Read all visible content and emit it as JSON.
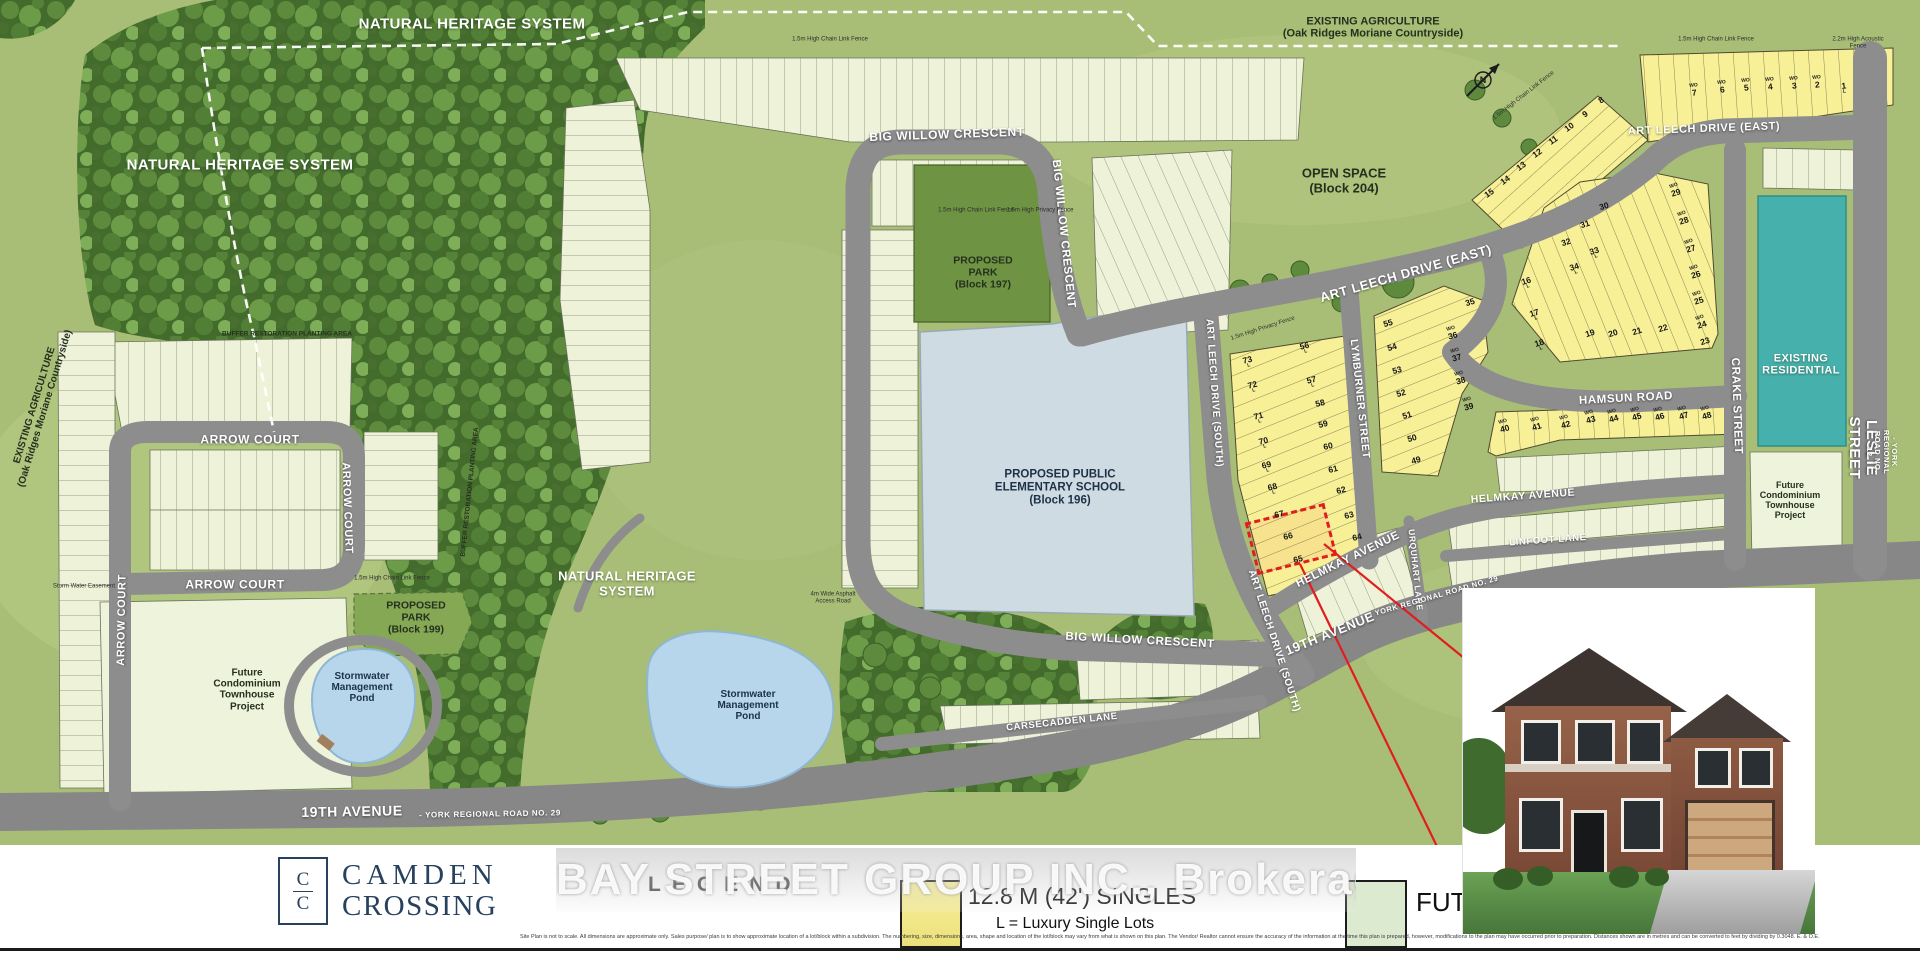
{
  "map": {
    "compass": "N",
    "labels": [
      {
        "id": "nhs-label-top",
        "t": "NATURAL HERITAGE SYSTEM",
        "x": 472,
        "y": 25,
        "fs": 15,
        "c": "lw"
      },
      {
        "id": "nhs-label-left",
        "t": "NATURAL HERITAGE SYSTEM",
        "x": 240,
        "y": 166,
        "fs": 15,
        "c": "lw"
      },
      {
        "id": "nhs-label-mid",
        "t": "NATURAL HERITAGE\nSYSTEM",
        "x": 627,
        "y": 584,
        "fs": 13,
        "c": "lw"
      },
      {
        "id": "existing-agriculture-topright",
        "t": "EXISTING AGRICULTURE\n(Oak Ridges Moriane Countryside)",
        "x": 1373,
        "y": 28,
        "fs": 11,
        "c": "ld"
      },
      {
        "id": "existing-agriculture-left",
        "t": "EXISTING AGRICULTURE\n(Oak Ridges Moriane Countryside)",
        "x": 40,
        "y": 407,
        "fs": 10,
        "rot": -73,
        "c": "ld"
      },
      {
        "id": "open-space-block-204",
        "t": "OPEN SPACE\n(Block 204)",
        "x": 1344,
        "y": 181,
        "fs": 13,
        "c": "ld"
      },
      {
        "id": "proposed-park-block-197",
        "t": "PROPOSED\nPARK\n(Block 197)",
        "x": 983,
        "y": 273,
        "fs": 10.5,
        "c": "ld"
      },
      {
        "id": "proposed-school-block-196",
        "t": "PROPOSED PUBLIC\nELEMENTARY SCHOOL\n(Block 196)",
        "x": 1060,
        "y": 488,
        "fs": 11.5,
        "c": "ln"
      },
      {
        "id": "proposed-park-block-199",
        "t": "PROPOSED\nPARK\n(Block 199)",
        "x": 416,
        "y": 618,
        "fs": 10.5,
        "c": "ld"
      },
      {
        "id": "future-condo-left",
        "t": "Future\nCondominium\nTownhouse\nProject",
        "x": 247,
        "y": 690,
        "fs": 10,
        "c": "ld"
      },
      {
        "id": "future-condo-right",
        "t": "Future\nCondominium\nTownhouse\nProject",
        "x": 1790,
        "y": 500,
        "fs": 9,
        "c": "ld"
      },
      {
        "id": "stormwater-pond-left",
        "t": "Stormwater\nManagement\nPond",
        "x": 362,
        "y": 688,
        "fs": 10,
        "c": "ln"
      },
      {
        "id": "stormwater-pond-mid",
        "t": "Stormwater\nManagement\nPond",
        "x": 748,
        "y": 706,
        "fs": 10,
        "c": "ln"
      },
      {
        "id": "existing-residential",
        "t": "EXISTING\nRESIDENTIAL",
        "x": 1801,
        "y": 365,
        "fs": 11,
        "c": "lw"
      },
      {
        "id": "buffer-restoration-h",
        "t": "BUFFER RESTORATION PLANTING AREA",
        "x": 287,
        "y": 334,
        "fs": 6.5,
        "c": "ld"
      },
      {
        "id": "buffer-restoration-v",
        "t": "BUFFER RESTORATION PLANTING AREA",
        "x": 470,
        "y": 492,
        "fs": 6.5,
        "rot": -84,
        "c": "ld"
      },
      {
        "id": "road-big-willow-top",
        "t": "BIG WILLOW CRESCENT",
        "x": 947,
        "y": 135,
        "fs": 12,
        "rot": -2,
        "c": "lr"
      },
      {
        "id": "road-big-willow-right",
        "t": "BIG WILLOW CRESCENT",
        "x": 1063,
        "y": 234,
        "fs": 11.5,
        "rot": 84,
        "c": "lr"
      },
      {
        "id": "road-big-willow-south",
        "t": "BIG WILLOW CRESCENT",
        "x": 1140,
        "y": 641,
        "fs": 11.5,
        "rot": 3,
        "c": "lr"
      },
      {
        "id": "road-arrow-court-top",
        "t": "ARROW COURT",
        "x": 250,
        "y": 440,
        "fs": 12,
        "c": "lr"
      },
      {
        "id": "road-arrow-court-right",
        "t": "ARROW COURT",
        "x": 347,
        "y": 508,
        "fs": 11,
        "rot": 88,
        "c": "lr"
      },
      {
        "id": "road-arrow-court-bottom",
        "t": "ARROW COURT",
        "x": 235,
        "y": 585,
        "fs": 12,
        "c": "lr"
      },
      {
        "id": "road-arrow-court-left",
        "t": "ARROW COURT",
        "x": 122,
        "y": 620,
        "fs": 11,
        "rot": -89,
        "c": "lr"
      },
      {
        "id": "road-art-leech-east-central",
        "t": "ART LEECH DRIVE (EAST)",
        "x": 1406,
        "y": 274,
        "fs": 13,
        "rot": -16,
        "c": "lr"
      },
      {
        "id": "road-art-leech-east-ne",
        "t": "ART LEECH DRIVE (EAST)",
        "x": 1704,
        "y": 129,
        "fs": 11,
        "rot": -2,
        "c": "lr"
      },
      {
        "id": "road-art-leech-south-upper",
        "t": "ART LEECH DRIVE (SOUTH)",
        "x": 1214,
        "y": 393,
        "fs": 10,
        "rot": 86,
        "c": "lr"
      },
      {
        "id": "road-art-leech-south-lower",
        "t": "ART LEECH DRIVE (SOUTH)",
        "x": 1274,
        "y": 641,
        "fs": 10,
        "rot": 72,
        "c": "lr"
      },
      {
        "id": "road-lymburner",
        "t": "LYMBURNER STREET",
        "x": 1359,
        "y": 399,
        "fs": 10.5,
        "rot": 84,
        "c": "lr"
      },
      {
        "id": "road-hamsun",
        "t": "HAMSUN ROAD",
        "x": 1626,
        "y": 399,
        "fs": 11.5,
        "rot": -3,
        "c": "lr"
      },
      {
        "id": "road-helmkay-west",
        "t": "HELMKAY AVENUE",
        "x": 1348,
        "y": 560,
        "fs": 11.5,
        "rot": -26,
        "c": "lr"
      },
      {
        "id": "road-helmkay-east",
        "t": "HELMKAY AVENUE",
        "x": 1523,
        "y": 497,
        "fs": 10.5,
        "rot": -4,
        "c": "lr"
      },
      {
        "id": "road-linfoot",
        "t": "LINFOOT LANE",
        "x": 1548,
        "y": 541,
        "fs": 9.5,
        "rot": -4,
        "c": "lr"
      },
      {
        "id": "road-urquhart",
        "t": "URQUHART LANE",
        "x": 1415,
        "y": 570,
        "fs": 8.5,
        "rot": 84,
        "c": "lr"
      },
      {
        "id": "road-crake",
        "t": "CRAKE STREET",
        "x": 1736,
        "y": 406,
        "fs": 11.5,
        "rot": 88,
        "c": "lr"
      },
      {
        "id": "road-carsecadden",
        "t": "CARSECADDEN LANE",
        "x": 1062,
        "y": 723,
        "fs": 9.5,
        "rot": -6,
        "c": "lr"
      },
      {
        "id": "road-19th-avenue-left",
        "t": "19TH AVENUE",
        "x": 352,
        "y": 812,
        "fs": 14,
        "rot": -1,
        "c": "lr"
      },
      {
        "id": "road-19th-avenue-left-sub",
        "t": "- YORK REGIONAL ROAD NO. 29",
        "x": 490,
        "y": 815,
        "fs": 8,
        "rot": -1,
        "c": "lr"
      },
      {
        "id": "road-19th-avenue-right",
        "t": "19TH AVENUE",
        "x": 1330,
        "y": 634,
        "fs": 13,
        "rot": -22,
        "c": "lr"
      },
      {
        "id": "road-19th-avenue-right-sub",
        "t": "- YORK REGIONAL ROAD NO. 29",
        "x": 1434,
        "y": 597,
        "fs": 7.5,
        "rot": -16,
        "c": "lr"
      },
      {
        "id": "road-leslie",
        "t": "LESLIE STREET",
        "x": 1862,
        "y": 448,
        "fs": 15,
        "rot": 90,
        "c": "lr"
      },
      {
        "id": "road-leslie-sub",
        "t": "- YORK REGIONAL ROAD NO. 12",
        "x": 1881,
        "y": 452,
        "fs": 7.5,
        "rot": 90,
        "c": "lr"
      },
      {
        "id": "fence-chainlink-top",
        "t": "1.5m High Chain Link Fence",
        "x": 830,
        "y": 40,
        "fs": 6,
        "c": "lf"
      },
      {
        "id": "fence-chainlink-topright",
        "t": "1.5m High Chain Link Fence",
        "x": 1716,
        "y": 40,
        "fs": 6,
        "c": "lf"
      },
      {
        "id": "fence-acoustic",
        "t": "2.2m High Acoustic Fence",
        "x": 1858,
        "y": 43,
        "fs": 6,
        "c": "lf"
      },
      {
        "id": "fence-chainlink-park",
        "t": "1.5m High Chain Link Fence",
        "x": 976,
        "y": 211,
        "fs": 6,
        "c": "lf"
      },
      {
        "id": "fence-privacy-park",
        "t": "1.5m High Privacy Fence",
        "x": 1040,
        "y": 211,
        "fs": 6,
        "c": "lf"
      },
      {
        "id": "fence-chainlink-ne",
        "t": "1.5m High Chain Link Fence",
        "x": 1524,
        "y": 96,
        "fs": 6,
        "rot": -38,
        "c": "lf"
      },
      {
        "id": "fence-chainlink-199",
        "t": "1.5m High Chain Link Fence",
        "x": 392,
        "y": 579,
        "fs": 6,
        "c": "lf"
      },
      {
        "id": "fence-privacy-west",
        "t": "1.5m High Privacy Fence",
        "x": 1263,
        "y": 329,
        "fs": 6,
        "rot": -18,
        "c": "lf"
      },
      {
        "id": "access-road-note",
        "t": "4m Wide Asphalt\nAccess Road",
        "x": 833,
        "y": 598,
        "fs": 6,
        "c": "lf"
      },
      {
        "id": "storm-water-easement",
        "t": "Storm Water Easement",
        "x": 84,
        "y": 587,
        "fs": 6,
        "c": "lf"
      }
    ],
    "lot_blocks": [
      {
        "name": "lots-1-7",
        "rot": -6,
        "lots": [
          {
            "n": "1",
            "x": 1844,
            "y": 88,
            "m": "L"
          },
          {
            "n": "2",
            "x": 1817,
            "y": 82,
            "m": "WO"
          },
          {
            "n": "3",
            "x": 1794,
            "y": 83,
            "m": "WO"
          },
          {
            "n": "4",
            "x": 1770,
            "y": 84,
            "m": "WO"
          },
          {
            "n": "5",
            "x": 1746,
            "y": 85,
            "m": "WO"
          },
          {
            "n": "6",
            "x": 1722,
            "y": 87,
            "m": "WO"
          },
          {
            "n": "7",
            "x": 1694,
            "y": 90,
            "m": "WO"
          }
        ]
      },
      {
        "name": "lots-8-15",
        "rot": -35,
        "lots": [
          {
            "n": "8",
            "x": 1601,
            "y": 100
          },
          {
            "n": "9",
            "x": 1585,
            "y": 114
          },
          {
            "n": "10",
            "x": 1569,
            "y": 127
          },
          {
            "n": "11",
            "x": 1553,
            "y": 140
          },
          {
            "n": "12",
            "x": 1537,
            "y": 153
          },
          {
            "n": "13",
            "x": 1521,
            "y": 166
          },
          {
            "n": "14",
            "x": 1505,
            "y": 180
          },
          {
            "n": "15",
            "x": 1489,
            "y": 193
          }
        ]
      },
      {
        "name": "lots-16-35",
        "rot": -18,
        "lots": [
          {
            "n": "16",
            "x": 1527,
            "y": 283,
            "m": "L"
          },
          {
            "n": "17",
            "x": 1535,
            "y": 315,
            "m": "L"
          },
          {
            "n": "18",
            "x": 1540,
            "y": 345,
            "m": "L"
          },
          {
            "n": "19",
            "x": 1590,
            "y": 333
          },
          {
            "n": "20",
            "x": 1613,
            "y": 333
          },
          {
            "n": "21",
            "x": 1637,
            "y": 331
          },
          {
            "n": "22",
            "x": 1663,
            "y": 328
          },
          {
            "n": "23",
            "x": 1705,
            "y": 341
          },
          {
            "n": "24",
            "x": 1701,
            "y": 322,
            "m": "WO"
          },
          {
            "n": "25",
            "x": 1698,
            "y": 298,
            "m": "WO"
          },
          {
            "n": "26",
            "x": 1695,
            "y": 272,
            "m": "WO"
          },
          {
            "n": "27",
            "x": 1690,
            "y": 246,
            "m": "WO"
          },
          {
            "n": "28",
            "x": 1683,
            "y": 218,
            "m": "WO"
          },
          {
            "n": "29",
            "x": 1675,
            "y": 190,
            "m": "WO"
          },
          {
            "n": "30",
            "x": 1604,
            "y": 206
          },
          {
            "n": "31",
            "x": 1585,
            "y": 224
          },
          {
            "n": "32",
            "x": 1566,
            "y": 242
          },
          {
            "n": "33",
            "x": 1595,
            "y": 253,
            "m": "L"
          },
          {
            "n": "34",
            "x": 1575,
            "y": 269,
            "m": "L"
          },
          {
            "n": "35",
            "x": 1470,
            "y": 302
          }
        ]
      },
      {
        "name": "lots-36-55",
        "rot": -16,
        "lots": [
          {
            "n": "36",
            "x": 1452,
            "y": 333,
            "m": "WO"
          },
          {
            "n": "37",
            "x": 1456,
            "y": 355,
            "m": "WO"
          },
          {
            "n": "38",
            "x": 1460,
            "y": 378,
            "m": "WO"
          },
          {
            "n": "39",
            "x": 1468,
            "y": 404,
            "m": "WO"
          },
          {
            "n": "40",
            "x": 1504,
            "y": 426,
            "m": "WO"
          },
          {
            "n": "41",
            "x": 1536,
            "y": 424,
            "m": "WO"
          },
          {
            "n": "42",
            "x": 1565,
            "y": 422,
            "m": "WO"
          },
          {
            "n": "43",
            "x": 1590,
            "y": 417,
            "m": "WO"
          },
          {
            "n": "44",
            "x": 1613,
            "y": 416,
            "m": "WO"
          },
          {
            "n": "45",
            "x": 1636,
            "y": 414,
            "m": "WO"
          },
          {
            "n": "46",
            "x": 1659,
            "y": 414,
            "m": "WO"
          },
          {
            "n": "47",
            "x": 1683,
            "y": 413,
            "m": "WO"
          },
          {
            "n": "48",
            "x": 1706,
            "y": 413,
            "m": "WO"
          },
          {
            "n": "49",
            "x": 1416,
            "y": 460
          },
          {
            "n": "50",
            "x": 1412,
            "y": 438
          },
          {
            "n": "51",
            "x": 1407,
            "y": 415
          },
          {
            "n": "52",
            "x": 1401,
            "y": 393
          },
          {
            "n": "53",
            "x": 1397,
            "y": 370
          },
          {
            "n": "54",
            "x": 1392,
            "y": 347
          },
          {
            "n": "55",
            "x": 1388,
            "y": 323
          }
        ]
      },
      {
        "name": "lots-56-73",
        "rot": -14,
        "lots": [
          {
            "n": "56",
            "x": 1305,
            "y": 348,
            "m": "L"
          },
          {
            "n": "57",
            "x": 1312,
            "y": 382,
            "m": "L"
          },
          {
            "n": "58",
            "x": 1320,
            "y": 403
          },
          {
            "n": "59",
            "x": 1323,
            "y": 424
          },
          {
            "n": "60",
            "x": 1328,
            "y": 446
          },
          {
            "n": "61",
            "x": 1333,
            "y": 469
          },
          {
            "n": "62",
            "x": 1341,
            "y": 490
          },
          {
            "n": "63",
            "x": 1349,
            "y": 515
          },
          {
            "n": "64",
            "x": 1357,
            "y": 537
          },
          {
            "n": "65",
            "x": 1298,
            "y": 559
          },
          {
            "n": "66",
            "x": 1288,
            "y": 536
          },
          {
            "n": "67",
            "x": 1279,
            "y": 514
          },
          {
            "n": "68",
            "x": 1273,
            "y": 489,
            "m": "L"
          },
          {
            "n": "69",
            "x": 1267,
            "y": 467,
            "m": "L"
          },
          {
            "n": "70",
            "x": 1264,
            "y": 443,
            "m": "L"
          },
          {
            "n": "71",
            "x": 1259,
            "y": 418,
            "m": "L"
          },
          {
            "n": "72",
            "x": 1253,
            "y": 387,
            "m": "L"
          },
          {
            "n": "73",
            "x": 1248,
            "y": 362,
            "m": "L"
          }
        ]
      }
    ],
    "callout": {
      "lot": "66",
      "box": {
        "x": 1250,
        "y": 512,
        "w": 76,
        "h": 48,
        "rot": -14
      }
    }
  },
  "legend": {
    "brand": {
      "mono_top": "C",
      "mono_bottom": "C",
      "name_line1": "CAMDEN",
      "name_line2": "CROSSING"
    },
    "heading": "LEGEND",
    "watermark": "BAY STREET GROUP INC., Brokerage",
    "items": [
      {
        "label": "12.8 M (42') SINGLES",
        "sublabel": "L = Luxury Single Lots",
        "swatch": "#f7ef8e"
      },
      {
        "label": "FUTU",
        "sublabel": "",
        "swatch": "#dcead0"
      }
    ],
    "disclaimer": "Site Plan is not to scale. All dimensions are approximate only. Sales purpose/ plan is to show approximate location of a lot/block within a subdivision. The numbering, size, dimensions, area, shape and location of the lot/block may vary from what is shown on this plan. The Vendor/ Realtor cannot ensure the accuracy of the information at the time this plan is prepared, however, modifications to the plan may have occurred prior to preparation. Distances shown are in metres and can be converted to feet by dividing by 0.3048. E. & O.E."
  }
}
